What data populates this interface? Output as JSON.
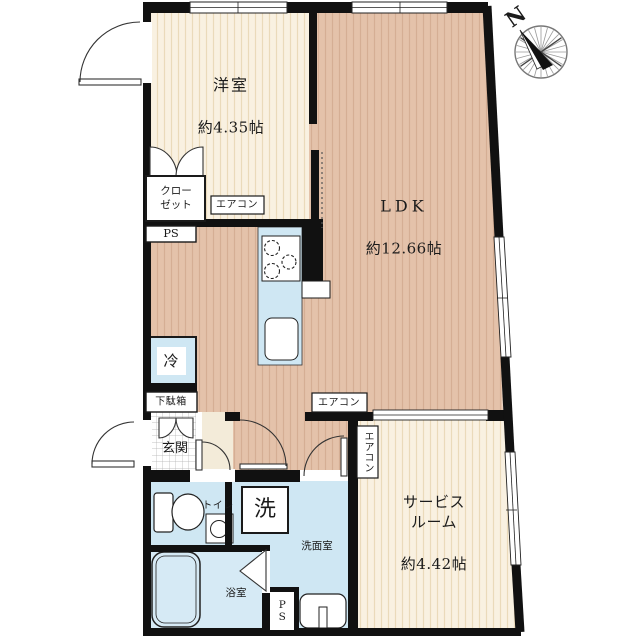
{
  "compass": {
    "north": "N"
  },
  "rooms": {
    "western": {
      "name": "洋室",
      "size": "約4.35帖"
    },
    "ldk": {
      "name": "LDK",
      "size": "約12.66帖"
    },
    "service": {
      "name": "サービス\nルーム",
      "size": "約4.42帖"
    },
    "entrance": {
      "label": "玄関"
    },
    "toilet": {
      "label": "トイレ"
    },
    "washroom": {
      "label": "洗面室"
    },
    "bathroom": {
      "label": "浴室"
    }
  },
  "fixtures": {
    "closet": "クロー\nゼット",
    "shoe_cabinet": "下駄箱",
    "refrigerator": "冷",
    "washing_machine": "洗",
    "aircon_western": "エアコン",
    "aircon_ldk": "エアコン",
    "aircon_service": "エアコン",
    "pipe_space_top": "PS",
    "pipe_space_bottom": "PS"
  },
  "colors": {
    "wall": "#111111",
    "wood_salmon": "#e4c2aa",
    "wood_cream": "#f9f1e1",
    "wet_area_blue": "#cfe7f3",
    "background": "#ffffff"
  }
}
